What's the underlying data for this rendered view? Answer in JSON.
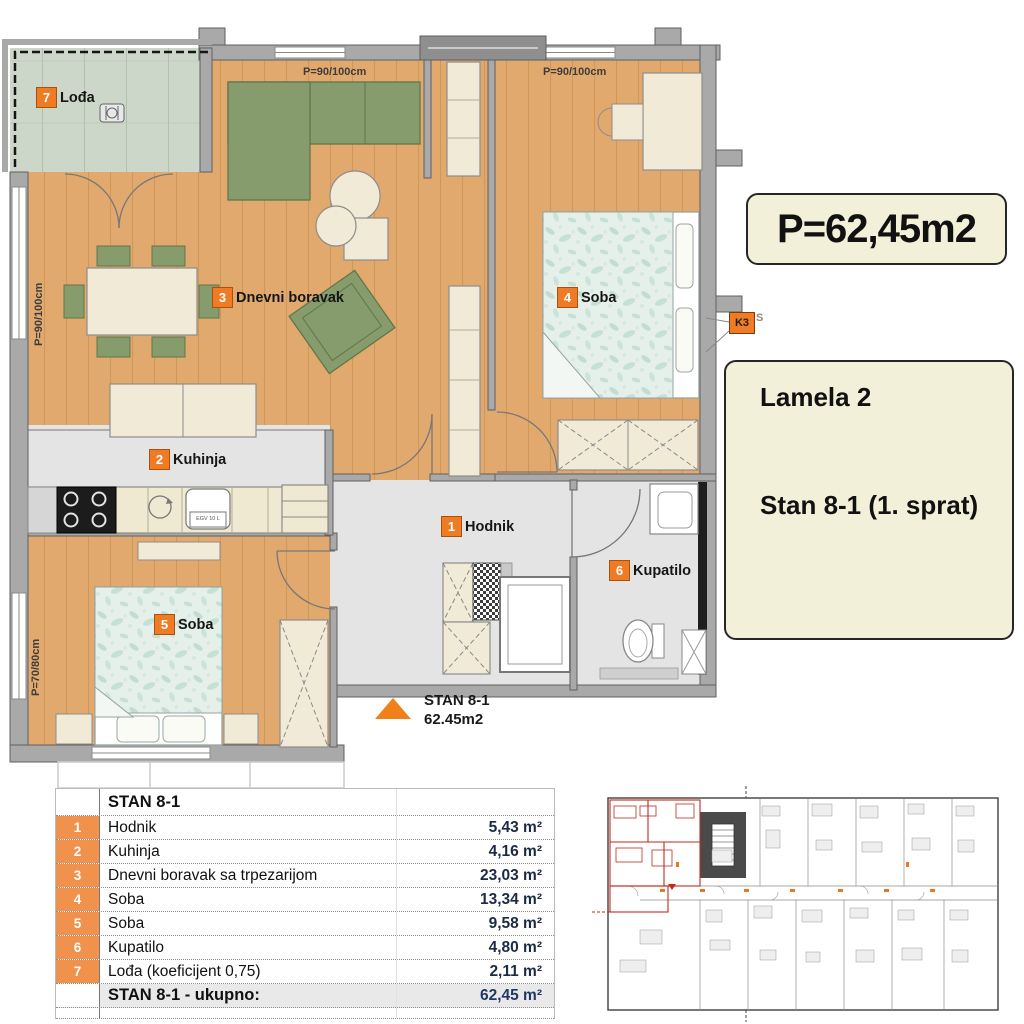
{
  "plan": {
    "area_box": "P=62,45m2",
    "info_box": {
      "building": "Lamela 2",
      "unit": "Stan 8-1 (1. sprat)"
    },
    "pointer": {
      "title": "STAN 8-1",
      "area": "62.45m2"
    },
    "k3_label": "K3",
    "k3_side": "S",
    "boiler_label": "EGV 10 L",
    "window_labels": {
      "top_left": "P=90/100cm",
      "top_right": "P=90/100cm",
      "left_upper": "P=90/100cm",
      "left_lower": "P=70/80cm"
    },
    "room_labels": [
      {
        "num": "1",
        "name": "Hodnik"
      },
      {
        "num": "2",
        "name": "Kuhinja"
      },
      {
        "num": "3",
        "name": "Dnevni boravak"
      },
      {
        "num": "4",
        "name": "Soba"
      },
      {
        "num": "5",
        "name": "Soba"
      },
      {
        "num": "6",
        "name": "Kupatilo"
      },
      {
        "num": "7",
        "name": "Lođa"
      }
    ]
  },
  "table": {
    "header": "STAN 8-1",
    "rows": [
      {
        "num": "1",
        "name": "Hodnik",
        "area": "5,43 m²"
      },
      {
        "num": "2",
        "name": "Kuhinja",
        "area": "4,16 m²"
      },
      {
        "num": "3",
        "name": "Dnevni boravak sa trpezarijom",
        "area": "23,03 m²"
      },
      {
        "num": "4",
        "name": "Soba",
        "area": "13,34 m²"
      },
      {
        "num": "5",
        "name": "Soba",
        "area": "9,58 m²"
      },
      {
        "num": "6",
        "name": "Kupatilo",
        "area": "4,80 m²"
      },
      {
        "num": "7",
        "name": "Lođa (koeficijent 0,75)",
        "area": "2,11 m²"
      }
    ],
    "total_label": "STAN 8-1 - ukupno:",
    "total_area": "62,45 m²"
  },
  "colors": {
    "accent_orange": "#f07b25",
    "cream_box": "#f3f0da",
    "wood_floor": "#e2a96e",
    "tile_floor": "#ccd7ca",
    "gray_floor": "#e4e4e4",
    "furniture_green": "#879c6c",
    "bed_teal": "#e5f0ea",
    "highlight_red": "#c22a1e"
  }
}
